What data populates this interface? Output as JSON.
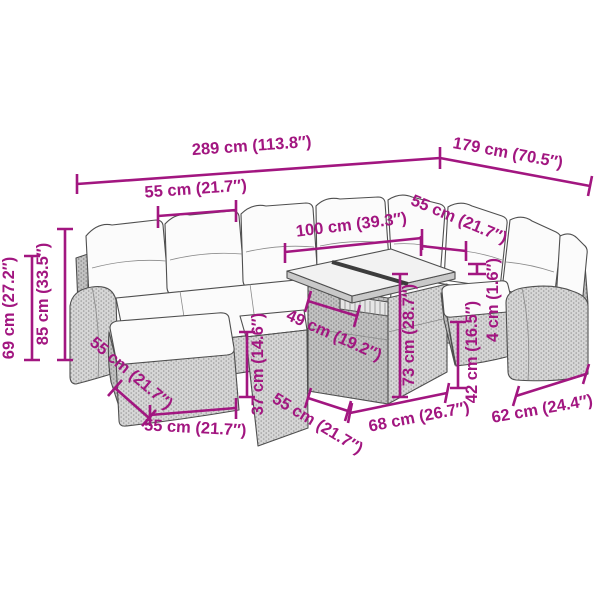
{
  "diagram": {
    "type": "furniture-dimension-diagram",
    "product": "garden lounge set line drawing",
    "accent_color": "#A21680",
    "outline_color": "#4F4F4F",
    "background_color": "#FFFFFF"
  },
  "dims": {
    "total_width": {
      "label": "289 cm (113.8″)"
    },
    "total_depth": {
      "label": "179 cm (70.5″)"
    },
    "seat_width_left": {
      "label": "55 cm (21.7″)"
    },
    "table_length": {
      "label": "100 cm (39.3″)"
    },
    "seat_width_right": {
      "label": "55 cm (21.7″)"
    },
    "arm_height": {
      "label": "69 cm (27.2″)"
    },
    "back_height": {
      "label": "85 cm (33.5″)"
    },
    "glass_panel": {
      "label": "49 cm (19.2″)"
    },
    "seat_height": {
      "label": "37 cm (14.6″)"
    },
    "table_height": {
      "label": "73 cm (28.7″)"
    },
    "stool_height": {
      "label": "42 cm (16.5″)"
    },
    "cushion_gap": {
      "label": "4 cm (1.6″)"
    },
    "ottoman_side": {
      "label": "55 cm (21.7″)"
    },
    "ottoman_front": {
      "label": "55 cm (21.7″)"
    },
    "mid_seat_depth": {
      "label": "55 cm (21.7″)"
    },
    "table_front": {
      "label": "68 cm (26.7″)"
    },
    "stool_width": {
      "label": "62 cm (24.4″)"
    }
  }
}
